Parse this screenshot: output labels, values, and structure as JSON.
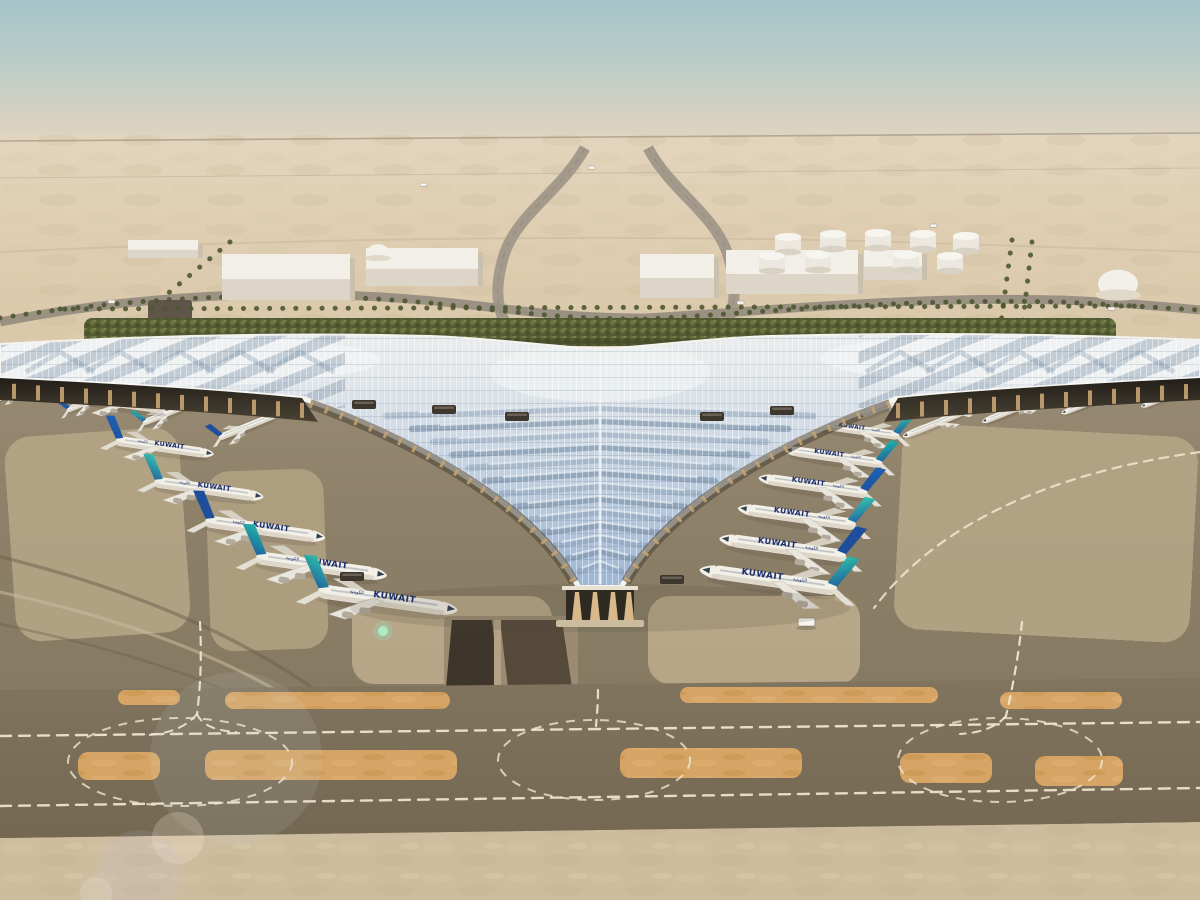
{
  "image_type": "architectural-aerial-rendering",
  "subject": {
    "description": "Aerial rendering of a desert airport terminal with a swooping trefoil lattice roof, airline jets parked at the gates, landscaped approach roads behind and taxiways with dashed markings in the foreground",
    "airline_title_en": "KUWAIT",
    "airline_title_ar": "الكويتية"
  },
  "palette": {
    "sky_top": "#a7c6cb",
    "sky_horizon": "#ded2bd",
    "desert": "#dfceb2",
    "desert_light": "#e9dcc5",
    "apron_base": "#8d8069",
    "apron_slab": "#b7a788",
    "taxiway": "#7b6f59",
    "sand_foreground": "#cdbc9e",
    "sand_island": "#d6a566",
    "roof_light": "#e8ebec",
    "roof_blue": "#9db6d4",
    "roof_slate": "#7c93ad",
    "roof_trim": "#f7f6f2",
    "facade_dark": "#3a342c",
    "column_tan": "#c8a472",
    "fuselage": "#f3f0e8",
    "tail_teal": "#2fb9a8",
    "tail_blue": "#1d4f9c",
    "title_navy": "#1c2e6b",
    "hedge_green": "#565d33",
    "palm_olive": "#4c5631",
    "marking_white": "#efe7d2"
  },
  "aircraft": {
    "title": "KUWAIT",
    "large_left": [
      {
        "x": 126,
        "y": 404,
        "s": 0.8,
        "tail": "#2fb9a8"
      },
      {
        "x": 162,
        "y": 447,
        "s": 0.9,
        "tail": "#1f61b0"
      },
      {
        "x": 206,
        "y": 489,
        "s": 1.0,
        "tail": "#35c2b0"
      },
      {
        "x": 262,
        "y": 529,
        "s": 1.1,
        "tail": "#1d4f9c"
      },
      {
        "x": 318,
        "y": 566,
        "s": 1.2,
        "tail": "#23b3a6"
      },
      {
        "x": 384,
        "y": 600,
        "s": 1.28,
        "tail": "#2fb9a8"
      }
    ],
    "large_right": [
      {
        "x": 858,
        "y": 430,
        "s": 0.8,
        "tail": "#2fb9a8"
      },
      {
        "x": 836,
        "y": 457,
        "s": 0.9,
        "tail": "#23b3a6"
      },
      {
        "x": 816,
        "y": 486,
        "s": 1.0,
        "tail": "#1f61b0"
      },
      {
        "x": 800,
        "y": 517,
        "s": 1.08,
        "tail": "#35c2b0"
      },
      {
        "x": 786,
        "y": 548,
        "s": 1.16,
        "tail": "#1d4f9c"
      },
      {
        "x": 772,
        "y": 580,
        "s": 1.26,
        "tail": "#2fb9a8"
      }
    ],
    "small_left": [
      {
        "x": 20,
        "y": 390,
        "s": 0.48,
        "tail": "#2fb9a8"
      },
      {
        "x": 92,
        "y": 400,
        "s": 0.52,
        "tail": "#1f61b0"
      },
      {
        "x": 170,
        "y": 412,
        "s": 0.56,
        "tail": "#35c2b0"
      },
      {
        "x": 248,
        "y": 426,
        "s": 0.6,
        "tail": "#1d4f9c"
      }
    ],
    "small_right": [
      {
        "x": 1168,
        "y": 396,
        "s": 0.5,
        "tail": "#1f61b0"
      },
      {
        "x": 1090,
        "y": 402,
        "s": 0.53,
        "tail": "#2fb9a8"
      },
      {
        "x": 1012,
        "y": 410,
        "s": 0.56,
        "tail": "#35c2b0"
      },
      {
        "x": 934,
        "y": 424,
        "s": 0.58,
        "tail": "#23b3a6"
      },
      {
        "x": 884,
        "y": 408,
        "s": 0.45,
        "tail": "#1d4f9c"
      }
    ]
  },
  "background": {
    "tanks": [
      {
        "x": 788,
        "y": 244
      },
      {
        "x": 833,
        "y": 241
      },
      {
        "x": 878,
        "y": 240
      },
      {
        "x": 923,
        "y": 241
      },
      {
        "x": 966,
        "y": 243
      },
      {
        "x": 772,
        "y": 263
      },
      {
        "x": 818,
        "y": 262
      },
      {
        "x": 906,
        "y": 262
      },
      {
        "x": 950,
        "y": 263
      }
    ],
    "warehouses": [
      {
        "x": 222,
        "y": 254,
        "w": 128,
        "h": 46
      },
      {
        "x": 366,
        "y": 248,
        "w": 112,
        "h": 38
      },
      {
        "x": 128,
        "y": 240,
        "w": 70,
        "h": 18
      },
      {
        "x": 640,
        "y": 254,
        "w": 74,
        "h": 44
      },
      {
        "x": 726,
        "y": 250,
        "w": 132,
        "h": 44
      },
      {
        "x": 864,
        "y": 250,
        "w": 58,
        "h": 30
      }
    ],
    "vehicles_roads": [
      {
        "x": 108,
        "y": 300
      },
      {
        "x": 420,
        "y": 183
      },
      {
        "x": 588,
        "y": 166
      },
      {
        "x": 737,
        "y": 301
      },
      {
        "x": 930,
        "y": 224
      },
      {
        "x": 1108,
        "y": 307
      }
    ],
    "apron_bus": {
      "x": 798,
      "y": 618,
      "w": 17,
      "h": 8
    }
  }
}
